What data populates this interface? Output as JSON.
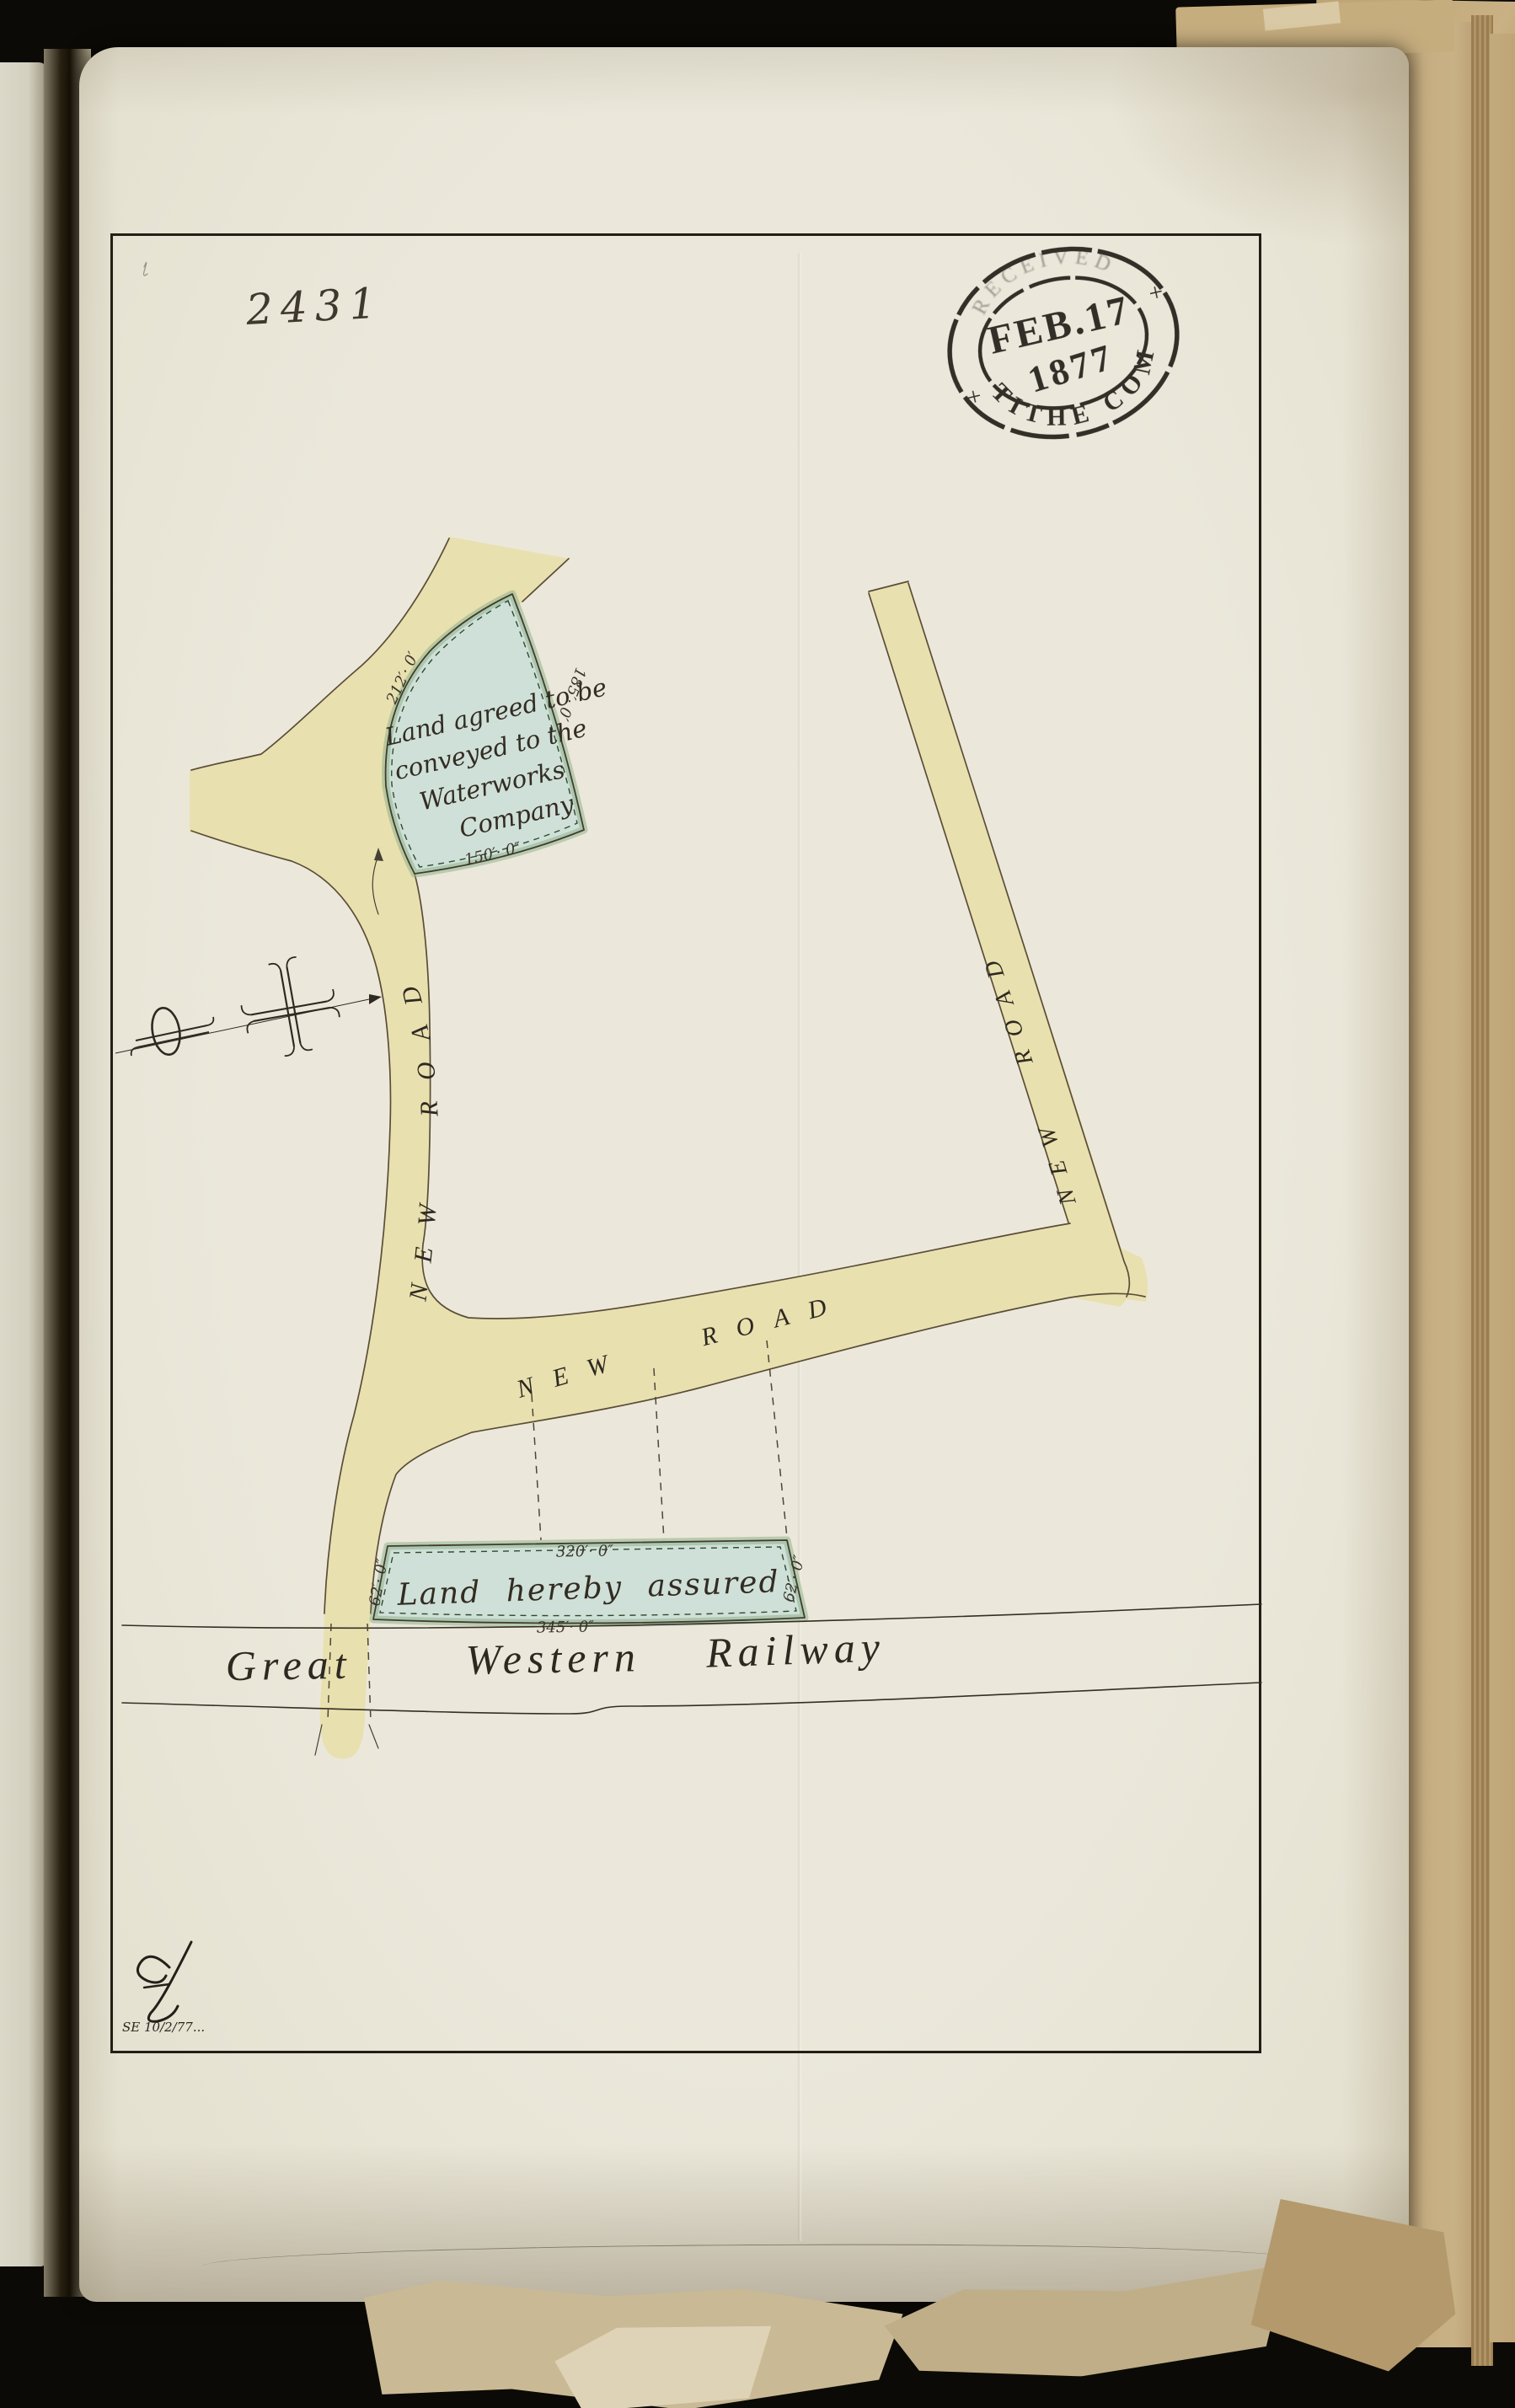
{
  "document": {
    "plan_number": "2431"
  },
  "stamp": {
    "received_text": "RECEIVED",
    "date": "FEB.17",
    "year": "1877",
    "office": "TITHE COM",
    "mark_left": "+",
    "mark_right": "+"
  },
  "map": {
    "road_left_label": "NEW ROAD",
    "road_middle_label": "NEW ROAD",
    "road_right_label": "NEW ROAD",
    "parcel_waterworks": {
      "line1": "Land agreed to be",
      "line2": "conveyed to the",
      "line3": "Waterworks",
      "line4": "Company",
      "dim_left": "212′· 0′",
      "dim_right": "185′· 0′",
      "dim_bottom": "150′· 0″"
    },
    "parcel_assured": {
      "label": "Land hereby assured",
      "dim_top": "320′· 0″",
      "dim_bottom": "345′· 0″",
      "dim_left": "62′· 0″",
      "dim_right": "62′· 0″"
    },
    "railway": {
      "word1": "Great",
      "word2": "Western",
      "word3": "Railway"
    }
  },
  "annotations": {
    "note": "SE 10/2/77..."
  },
  "colors": {
    "paper": "#e8e4d4",
    "road": "#e9e0b0",
    "parcel": "#cfe0d8",
    "ink": "#30291f",
    "stamp_ink": "#1f1b15"
  }
}
